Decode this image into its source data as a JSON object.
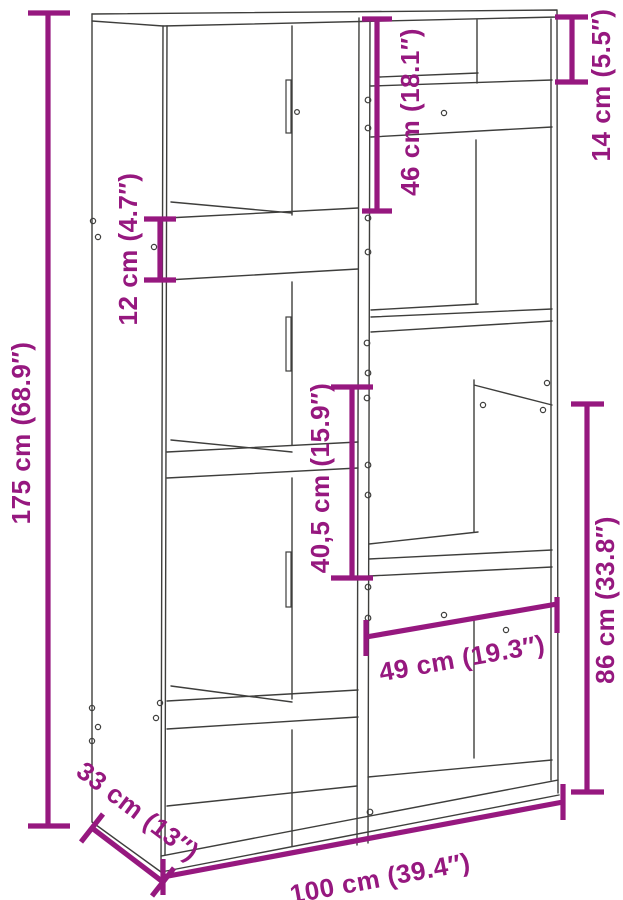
{
  "meta": {
    "description_label": "Bookcase / room-divider dimension diagram"
  },
  "colors": {
    "dimension_accent": "#96187F",
    "drawing_outline": "#3E3E3C",
    "page_background": "#FFFFFF"
  },
  "dimensions": {
    "total_height": {
      "cm": "175",
      "inch": "68.9",
      "label": "175 cm (68.9″)"
    },
    "shelf_gap": {
      "cm": "12",
      "inch": "4.7",
      "label": "12 cm (4.7″)"
    },
    "upper_opening": {
      "cm": "46",
      "inch": "18.1",
      "label": "46 cm (18.1″)"
    },
    "top_compartment": {
      "cm": "14",
      "inch": "5.5",
      "label": "14 cm (5.5″)"
    },
    "middle_opening": {
      "cm": "40,5",
      "inch": "15.9",
      "label": "40,5 cm (15.9″)"
    },
    "lower_right_height": {
      "cm": "86",
      "inch": "33.8",
      "label": "86 cm (33.8″)"
    },
    "lower_opening_width": {
      "cm": "49",
      "inch": "19.3",
      "label": "49 cm (19.3″)"
    },
    "depth": {
      "cm": "33",
      "inch": "13",
      "label": "33 cm (13″)"
    },
    "total_width": {
      "cm": "100",
      "inch": "39.4",
      "label": "100 cm (39.4″)"
    }
  }
}
